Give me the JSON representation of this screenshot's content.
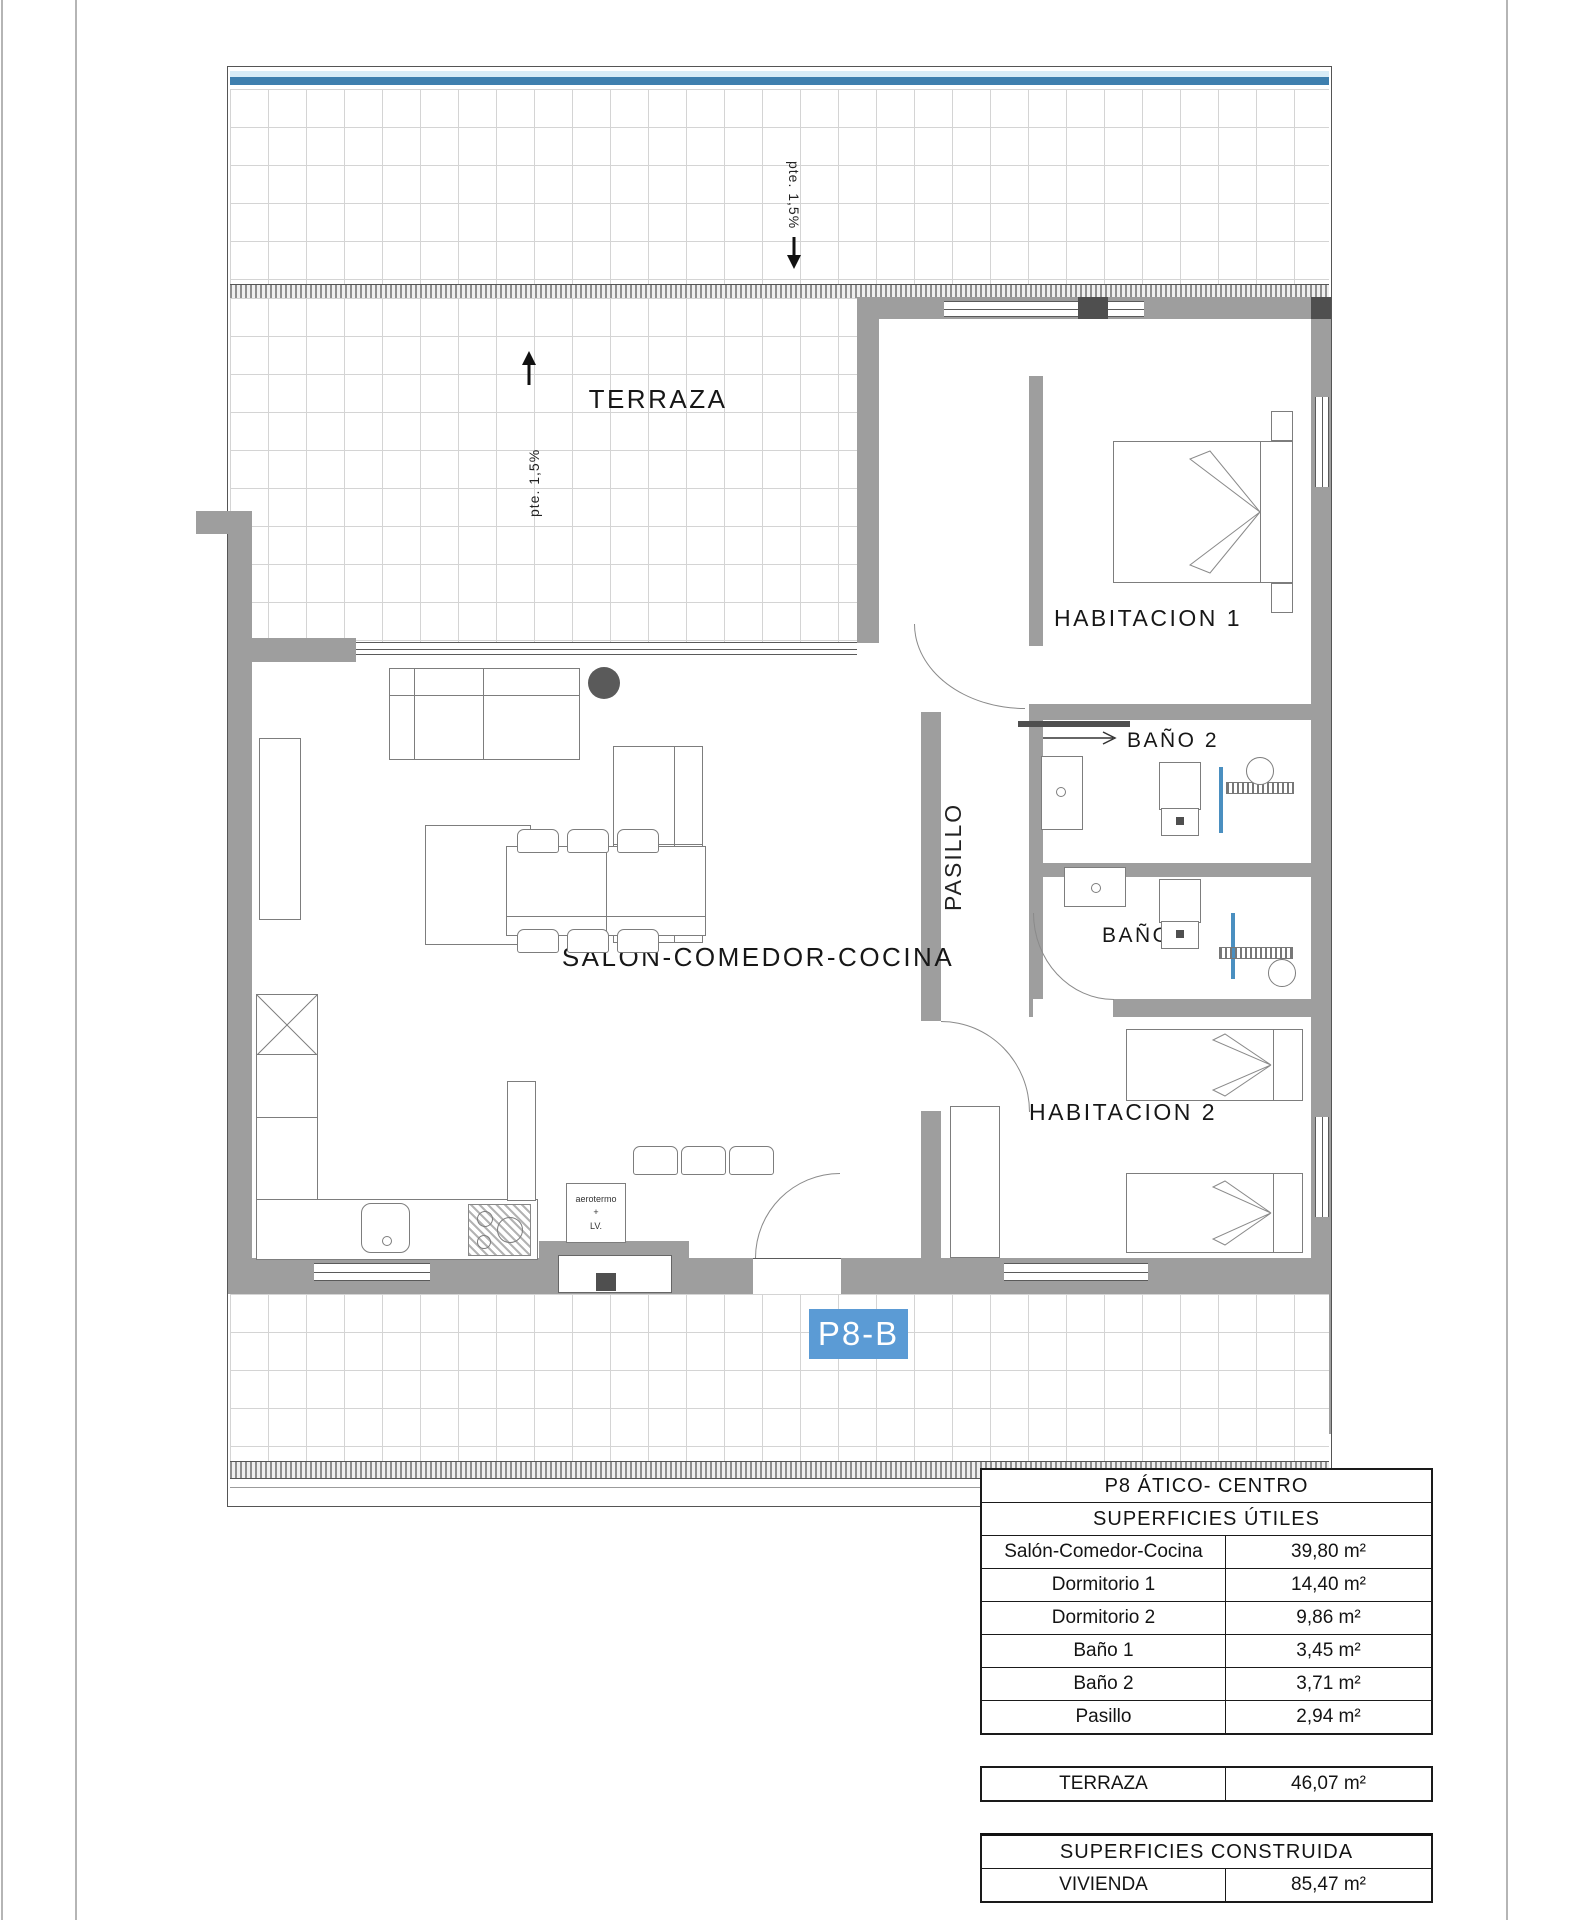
{
  "plan": {
    "unit_badge": "P8-B",
    "rooms": {
      "terraza": "TERRAZA",
      "salon": "SALON-COMEDOR-COCINA",
      "habitacion1": "HABITACION 1",
      "habitacion2": "HABITACION 2",
      "bano1": "BAÑO 1",
      "bano2": "BAÑO 2",
      "pasillo": "PASILLO"
    },
    "annotations": {
      "roof_slope": "pte. 1,5%",
      "terrace_slope": "pte. 1,5%",
      "aerotermo_line1": "aerotermo",
      "aerotermo_line2": "+",
      "aerotermo_line3": "LV."
    },
    "colors": {
      "badge_blue": "#5b9bd5",
      "stripe_light": "#d8ecf7",
      "stripe_dark": "#3e7fae",
      "wall_gray": "#9e9e9e",
      "fixture_blue": "#4a8fc0"
    }
  },
  "tables": {
    "useful": {
      "title": "P8 ÁTICO- CENTRO",
      "subtitle": "SUPERFICIES ÚTILES",
      "rows": [
        {
          "label": "Salón-Comedor-Cocina",
          "value": "39,80 m²"
        },
        {
          "label": "Dormitorio 1",
          "value": "14,40 m²"
        },
        {
          "label": "Dormitorio 2",
          "value": "9,86 m²"
        },
        {
          "label": "Baño 1",
          "value": "3,45 m²"
        },
        {
          "label": "Baño 2",
          "value": "3,71 m²"
        },
        {
          "label": "Pasillo",
          "value": "2,94 m²"
        }
      ]
    },
    "terrace": {
      "label": "TERRAZA",
      "value": "46,07 m²"
    },
    "built": {
      "title": "SUPERFICIES CONSTRUIDA",
      "label": "VIVIENDA",
      "value": "85,47 m²"
    }
  }
}
